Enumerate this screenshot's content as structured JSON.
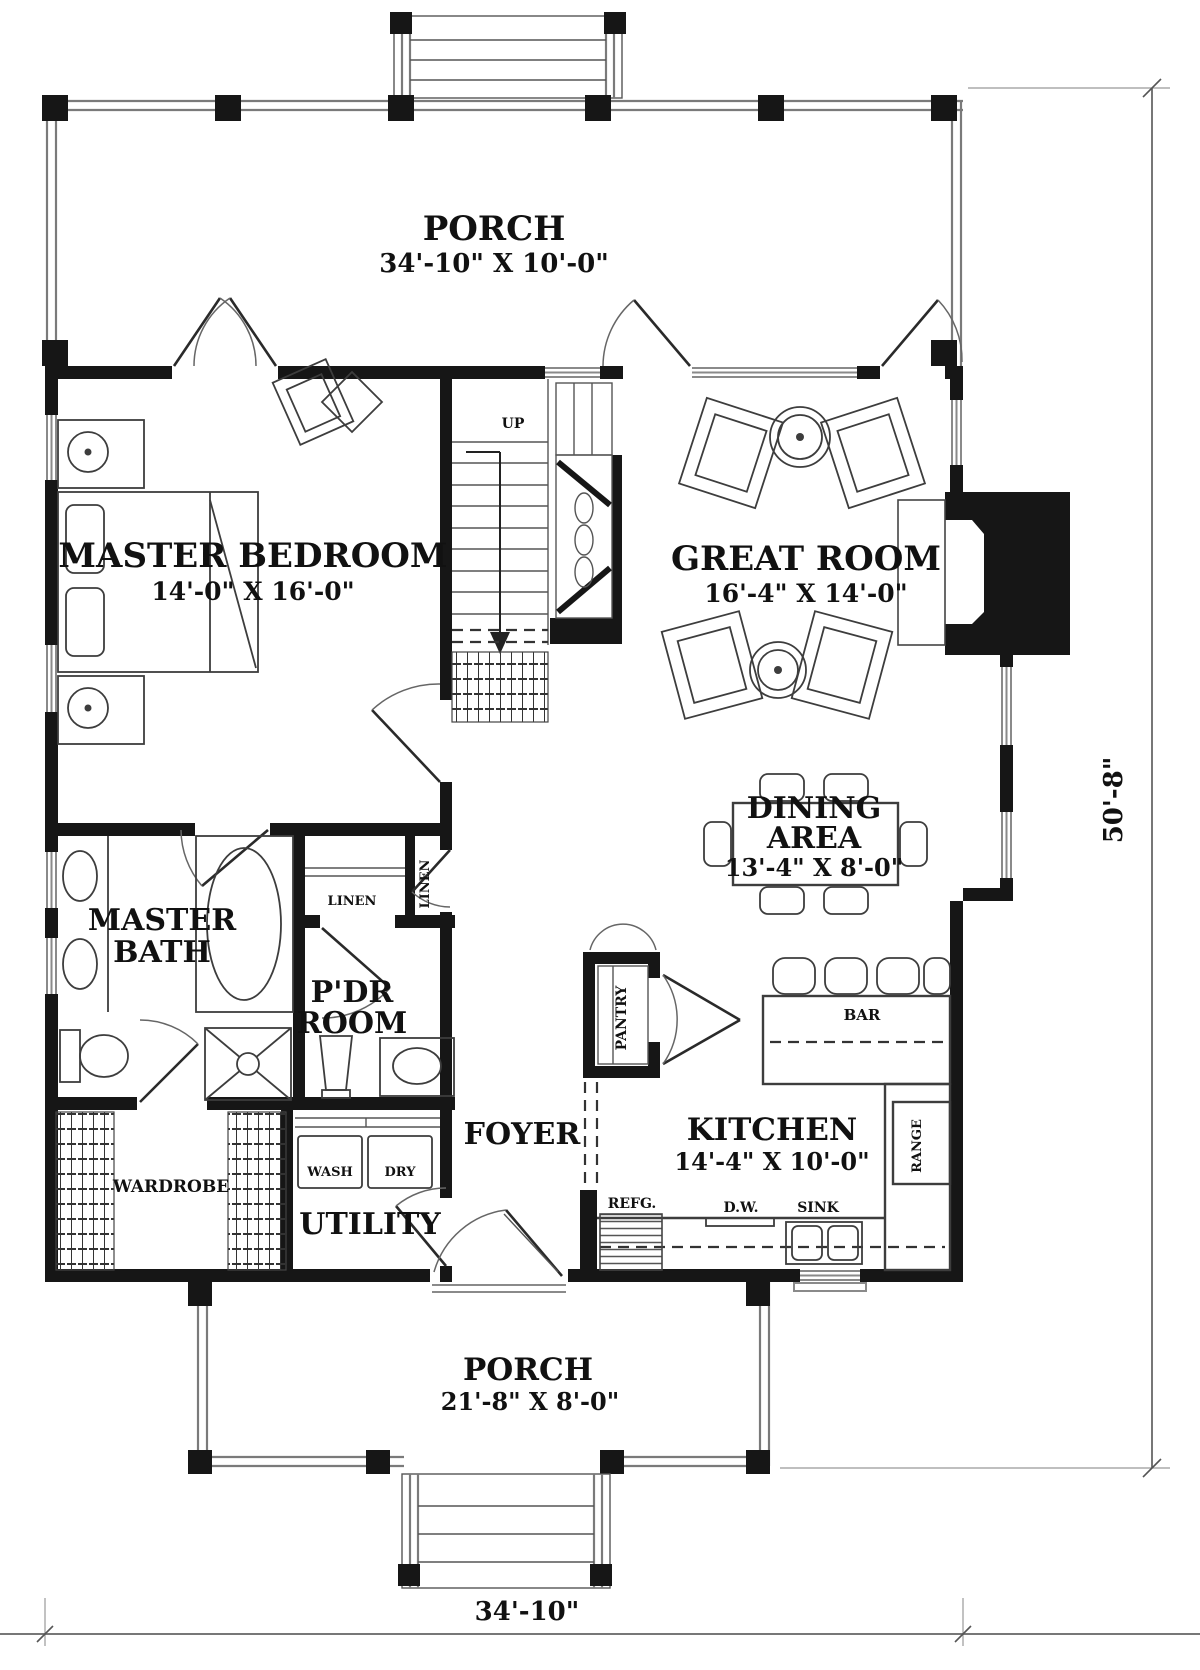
{
  "rooms": {
    "porch_top": {
      "name": "PORCH",
      "dims": "34'-10\" X 10'-0\""
    },
    "master_bedroom": {
      "name": "MASTER BEDROOM",
      "dims": "14'-0\" X 16'-0\""
    },
    "great_room": {
      "name": "GREAT ROOM",
      "dims": "16'-4\" X 14'-0\""
    },
    "dining_area": {
      "line1": "DINING",
      "line2": "AREA",
      "dims": "13'-4\" X 8'-0\""
    },
    "master_bath": {
      "line1": "MASTER",
      "line2": "BATH"
    },
    "powder_room": {
      "line1": "P'DR",
      "line2": "ROOM"
    },
    "foyer": {
      "name": "FOYER"
    },
    "kitchen": {
      "name": "KITCHEN",
      "dims": "14'-4\" X 10'-0\""
    },
    "utility": {
      "name": "UTILITY"
    },
    "wardrobe": {
      "name": "WARDROBE"
    },
    "porch_bottom": {
      "name": "PORCH",
      "dims": "21'-8\" X 8'-0\""
    }
  },
  "closets": {
    "linen_left": "LINEN",
    "linen_right": "LINEN",
    "pantry": "PANTRY"
  },
  "fixtures": {
    "bar": "BAR",
    "range": "RANGE",
    "refrigerator": "REFG.",
    "dishwasher": "D.W.",
    "sink": "SINK",
    "washer": "WASH",
    "dryer": "DRY"
  },
  "stairs": {
    "up_label": "UP"
  },
  "dimensions": {
    "overall_width": "34'-10\"",
    "overall_depth": "50'-8\""
  },
  "colors": {
    "wall": "#161616",
    "furniture_line": "#3d3d3d",
    "window_line": "#8a8a8a",
    "text": "#111111",
    "background": "#ffffff"
  }
}
